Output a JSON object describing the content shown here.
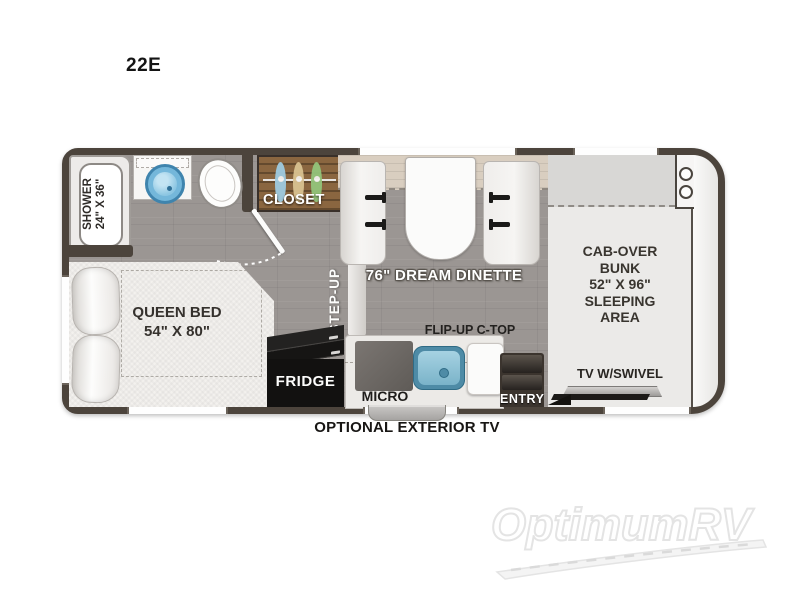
{
  "title": "22E",
  "plan": {
    "shower": {
      "line1": "SHOWER",
      "line2": "24\" X 36\""
    },
    "queen_bed": {
      "line1": "QUEEN BED",
      "line2": "54\" X 80\""
    },
    "closet_label": "CLOSET",
    "step_up_label": "STEP-UP",
    "dinette_label": "76\" DREAM DINETTE",
    "flip_up_label": "FLIP-UP C-TOP",
    "micro_label": "MICRO",
    "fridge_label": "FRIDGE",
    "entry_label": "ENTRY",
    "bunk": {
      "line1": "CAB-OVER",
      "line2": "BUNK",
      "line3": "52\" X 96\"",
      "line4": "SLEEPING",
      "line5": "AREA"
    },
    "tv_label": "TV W/SWIVEL"
  },
  "caption": "OPTIONAL EXTERIOR TV",
  "watermark": "OptimumRV",
  "colors": {
    "wall": "#4c443c",
    "floor": "#9b9693",
    "closet_wood": "#8a6640",
    "sink_blue": "#7ab3c9",
    "fridge_black": "#121110",
    "hanger_blue": "#9fcbe0",
    "hanger_tan": "#d9c291",
    "hanger_green": "#93c47a"
  }
}
